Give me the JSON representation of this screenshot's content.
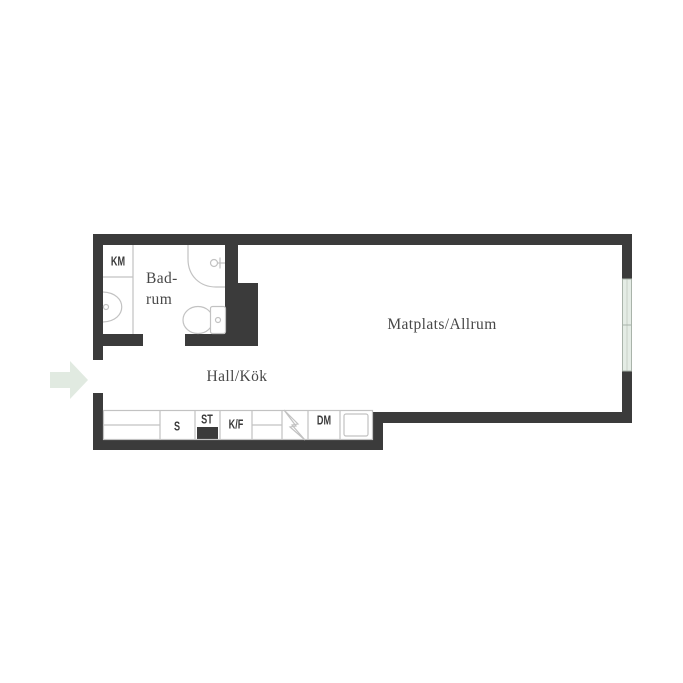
{
  "colors": {
    "wall": "#3b3b3b",
    "window": "#e4ece5",
    "winline": "#a9b3aa",
    "arrow": "#e1eae1",
    "line": "#c2c2c2",
    "text": "#474747"
  },
  "rooms": {
    "badrum": {
      "line1": "Bad-",
      "line2": "rum"
    },
    "hall_kok": "Hall/Kök",
    "matplats": "Matplats/Allrum"
  },
  "labels": {
    "km": "KM",
    "s": "S",
    "st": "ST",
    "kf": "K/F",
    "dm": "DM"
  },
  "icons": {
    "entrance_arrow": "entrance direction arrow",
    "stove": "stove zigzag symbol",
    "toilet": "toilet",
    "bath_sink": "bathroom washbasin",
    "shower": "shower tray",
    "kitchen_sink": "kitchen sink",
    "window": "window glazing"
  }
}
